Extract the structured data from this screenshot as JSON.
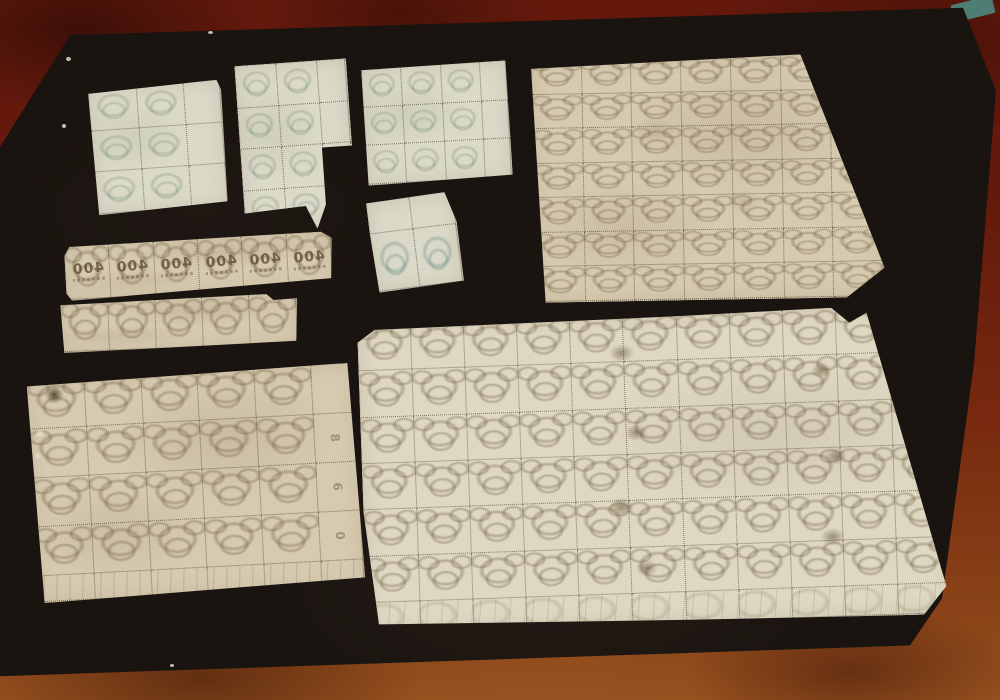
{
  "colors": {
    "wood_top": "#64190c",
    "wood_mid": "#78290f",
    "wood_bottom": "#8a4418",
    "wood_light": "#96511f",
    "board": "#1a1410",
    "teal_object": "#4e7d74",
    "paper_green": "#dbd9c8",
    "paper_tan": "#d6cab0",
    "paper_cream": "#ded7c2",
    "pattern_green": "rgba(106,134,106,0.32)",
    "pattern_teal": "rgba(88,128,122,0.35)",
    "pattern_tan": "rgba(110,92,62,0.38)",
    "perforation": "rgba(48,38,24,0.55)",
    "overprint": "#5c4730",
    "stain_brown": "rgba(72,52,22,0.45)"
  },
  "sheets": [
    {
      "name": "green-block-3-rows-with-right-margin",
      "rows": 3,
      "cols": 2,
      "tint": "green",
      "right_margin_px": 36
    },
    {
      "name": "green-block-4-rows-stepped-edge",
      "rows": 4,
      "cols": 2,
      "tint": "green",
      "right_margin_px": 28
    },
    {
      "name": "green-block-3x3-with-right-margin",
      "rows": 3,
      "cols": 3,
      "tint": "green",
      "right_margin_px": 26
    },
    {
      "name": "pair-with-top-selvage-tab",
      "rows": 1,
      "cols": 2,
      "tint": "teal",
      "top_margin_px": 32
    },
    {
      "name": "strip-of-6-with-overprint",
      "rows": 1,
      "cols": 6,
      "tint": "tan",
      "overprint": "400"
    },
    {
      "name": "strip-of-5",
      "rows": 1,
      "cols": 5,
      "tint": "tan"
    },
    {
      "name": "block-5x4-with-margins",
      "rows": 4,
      "cols": 5,
      "tint": "tan",
      "right_margin_px": 42,
      "bottom_margin_px": 26,
      "margin_numbers": [
        "8",
        "6",
        "0"
      ]
    },
    {
      "name": "large-block-7x7",
      "rows": 7,
      "cols": 7,
      "tint": "tan"
    },
    {
      "name": "large-sheet-11x6-with-bottom-margin",
      "rows": 6,
      "cols": 11,
      "tint": "cream",
      "bottom_margin_px": 30
    }
  ],
  "overprint_value": "400"
}
